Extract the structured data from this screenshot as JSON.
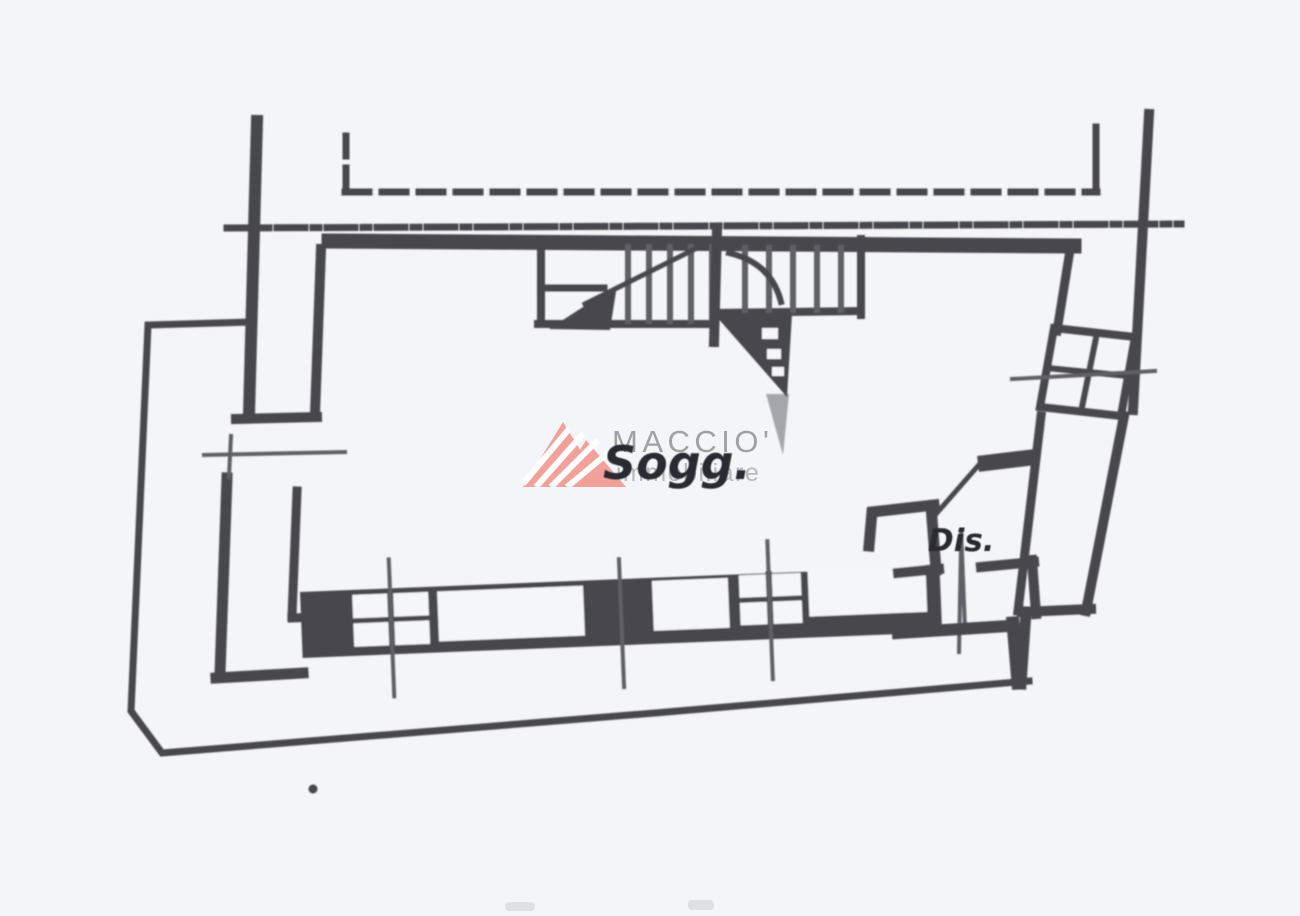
{
  "plan": {
    "rooms": [
      {
        "label": "Sogg."
      },
      {
        "label": "Dis."
      }
    ]
  },
  "watermark": {
    "title": "MACCIO'",
    "subtitle": "immobiliare",
    "logo_icon": "mountain-peaks-icon"
  },
  "colors": {
    "bg": "#f4f5f8",
    "paper": "#f5f6f9",
    "ink": "#47474d",
    "soft": "#5f5f66",
    "label": "#2b2b31",
    "wmred": "#f29a93",
    "wmgray": "#9b9a9c",
    "wmlight": "#b4b3b6"
  }
}
